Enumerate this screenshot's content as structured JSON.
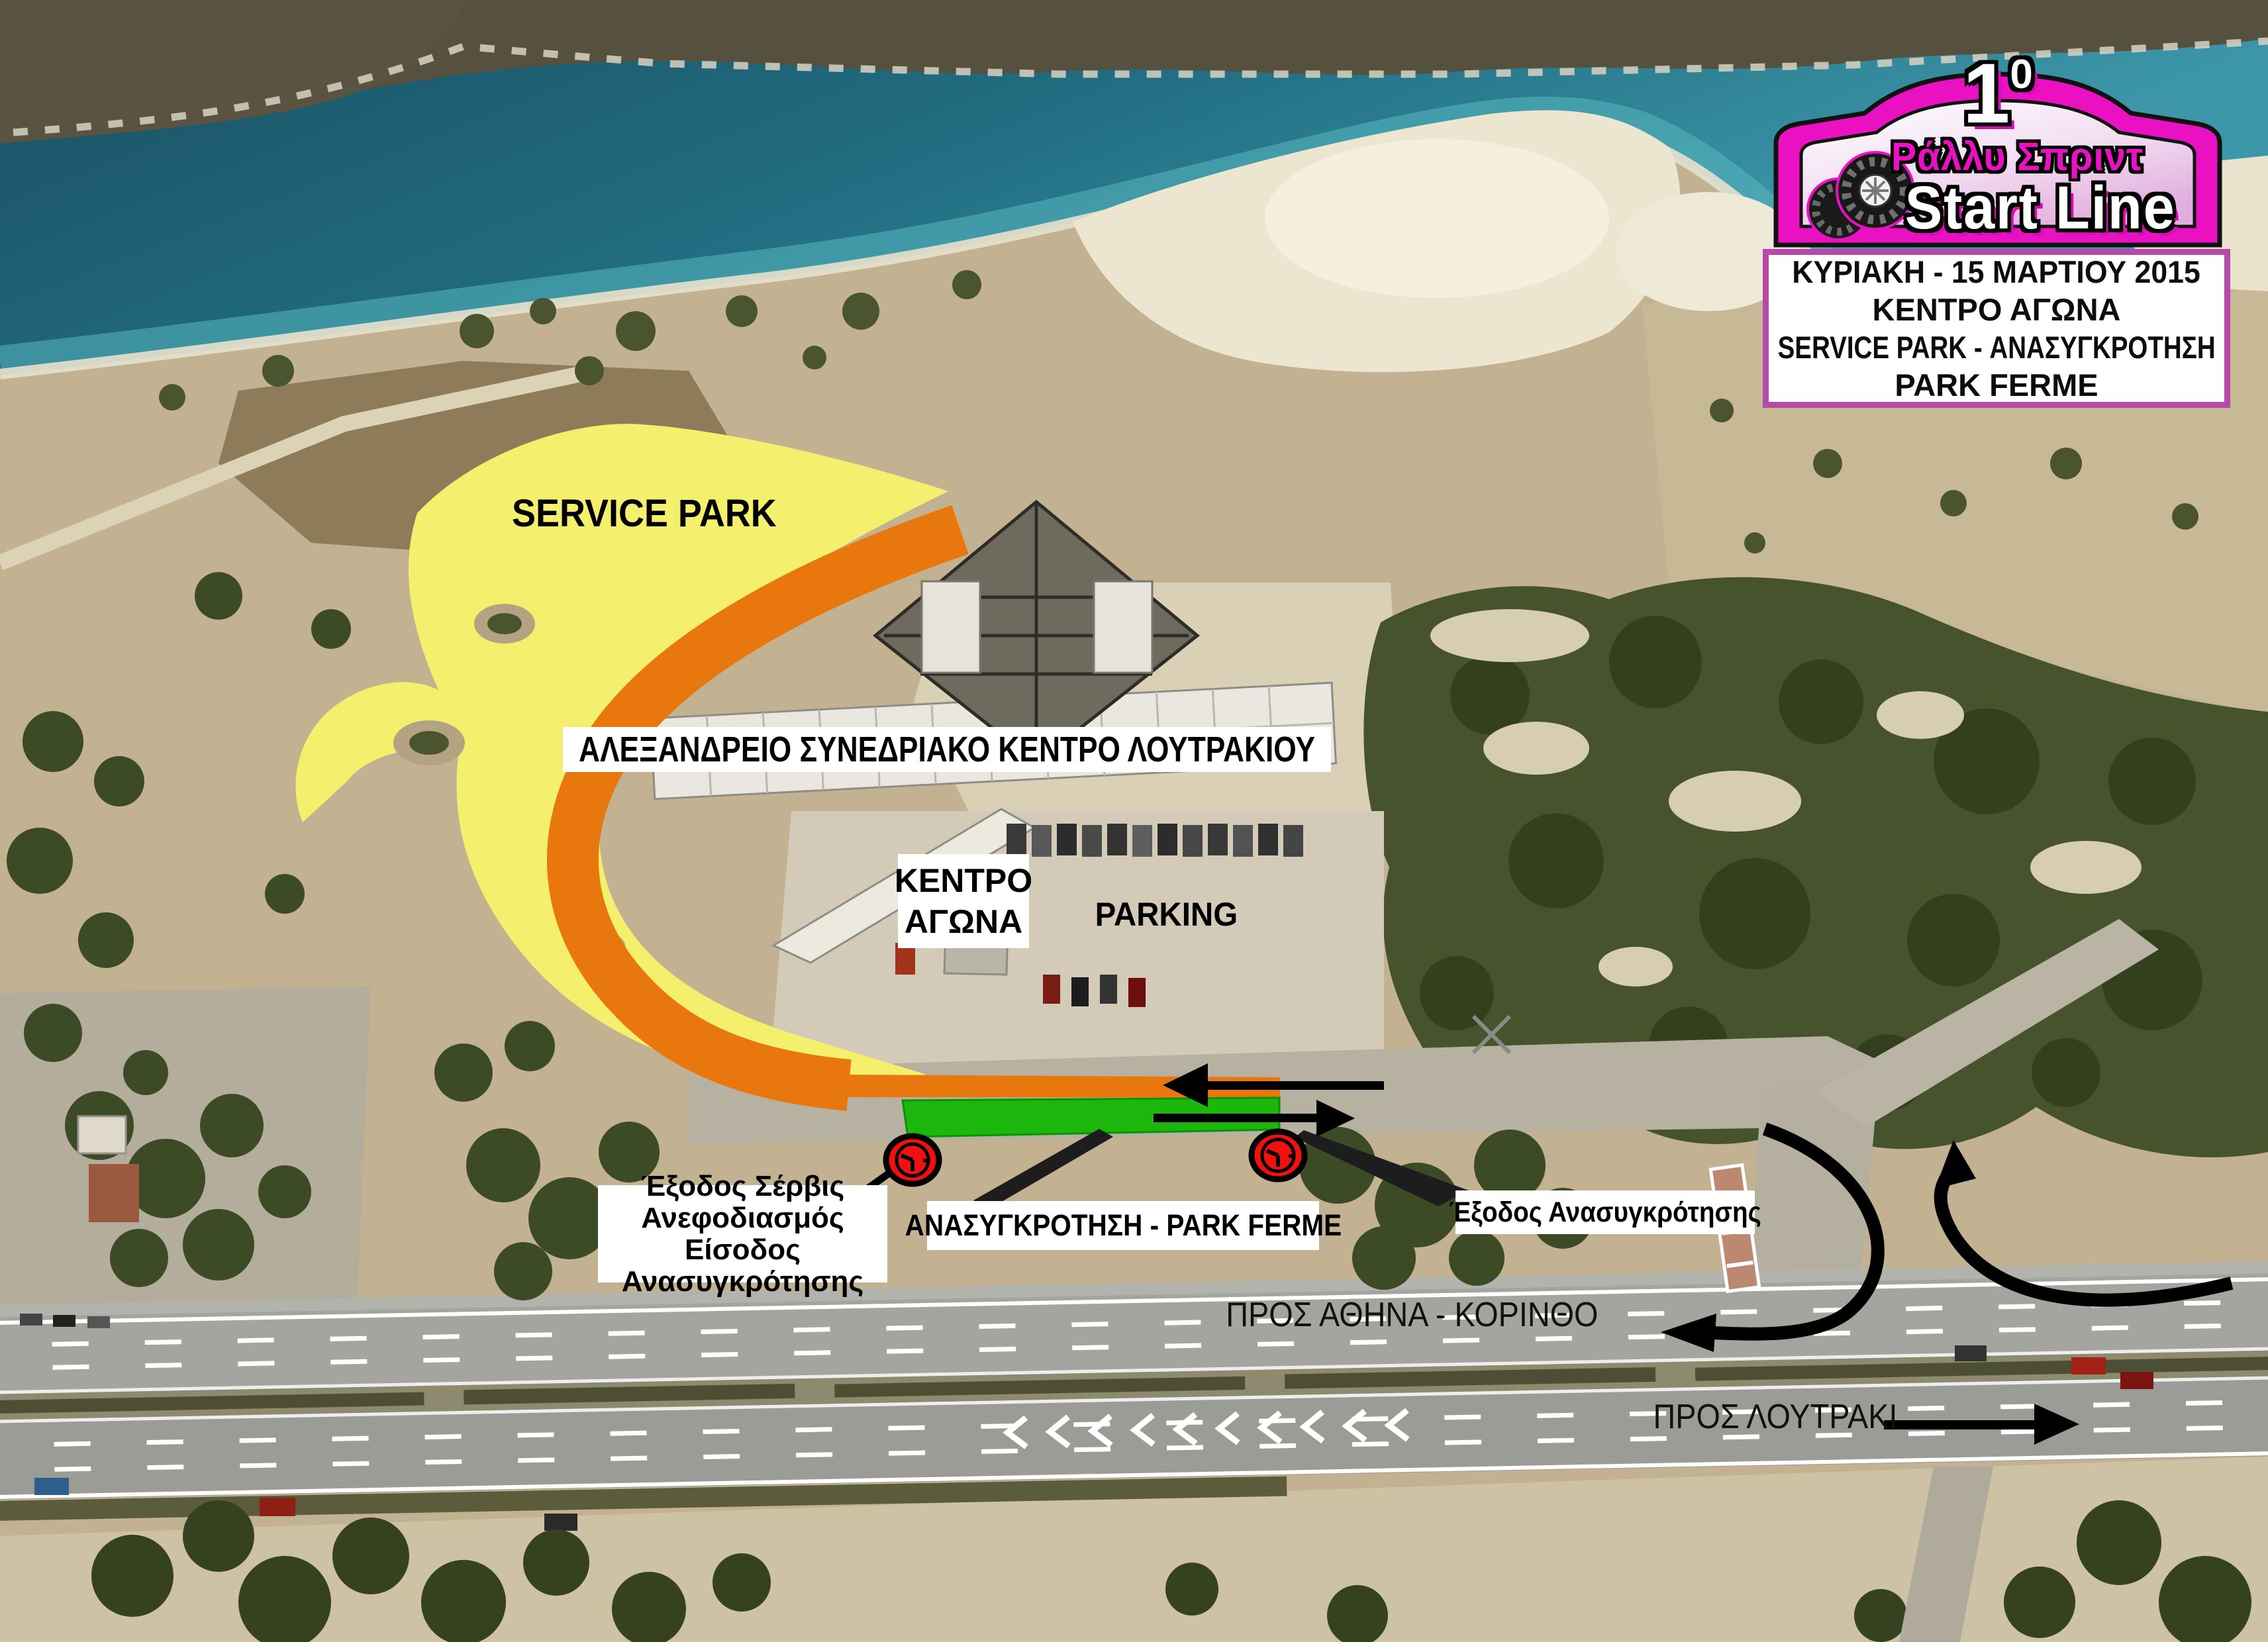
{
  "plate": {
    "rank": "1",
    "rank_suffix": "0",
    "series": "Ράλλυ Σπριντ",
    "name": "Start Line"
  },
  "info_box": {
    "lines": [
      "ΚΥΡΙΑΚΗ - 15 ΜΑΡΤΙΟΥ 2015",
      "ΚΕΝΤΡΟ ΑΓΩΝΑ",
      "SERVICE PARK - ΑΝΑΣΥΓΚΡΟΤΗΣΗ",
      "PARK FERME"
    ]
  },
  "areas": {
    "service_park": "SERVICE PARK",
    "venue": "ΑΛΕΞΑΝΔΡΕΙΟ ΣΥΝΕΔΡΙΑΚΟ ΚΕΝΤΡΟ ΛΟΥΤΡΑΚΙΟΥ",
    "race_hq": "ΚΕΝΤΡΟ ΑΓΩΝΑ",
    "parking": "PARKING"
  },
  "callouts": {
    "service_exit_lines": [
      "Έξοδος Σέρβις",
      "Ανεφοδιασμός",
      "Είσοδος Ανασυγκρότησης"
    ],
    "regroup": "ΑΝΑΣΥΓΚΡΟΤΗΣΗ - PARK FERME",
    "regroup_exit": "Έξοδος Ανασυγκρότησης"
  },
  "directions": {
    "to_athens": "ΠΡΟΣ ΑΘΗΝΑ - ΚΟΡΙΝΘΟ",
    "to_loutraki": "ΠΡΟΣ ΛΟΥΤΡΑΚΙ"
  },
  "icons": {
    "time_control": "clock-icon"
  },
  "colors": {
    "service_park_fill": "#f4f06e",
    "route_fill": "#e8780e",
    "regroup_fill": "#1cb70d",
    "time_control_fill": "#f01010",
    "plate_magenta": "#e911c1",
    "info_border": "#b54aaa",
    "water": "#1d6073"
  }
}
